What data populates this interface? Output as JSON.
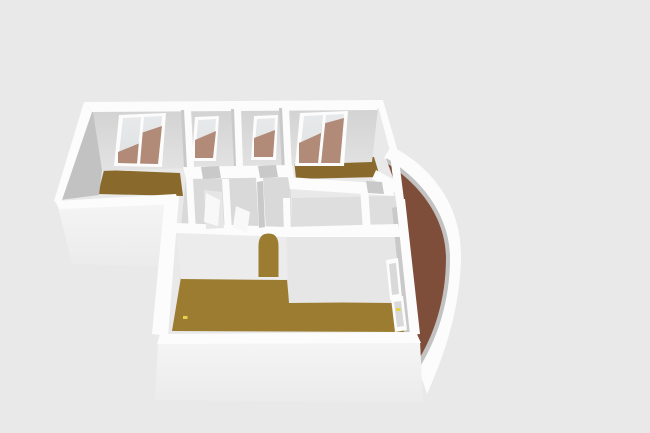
{
  "canvas": {
    "width": 650,
    "height": 433
  },
  "palette": {
    "background": "#e9e9e9",
    "wall_top": "#fcfcfc",
    "outer_from": "#f5f5f5",
    "outer_to": "#ebebeb",
    "face_top_from": "#d2d2d2",
    "face_top_to": "#e3e3e3",
    "wall_face_dark": "#c2c2c2",
    "wall_face_mid": "#c9c9c9",
    "wall_face_lit": "#ececec",
    "wall_face_lit2": "#e6e6e6",
    "hall_floor": "#d9d9d9",
    "hall_floor_light": "#dedede",
    "parquet_dark": "#8a6a2c",
    "parquet_line_dark": "#785b22",
    "parquet_gold": "#9c7c30",
    "parquet_line_gold": "#876826",
    "brick": "#7f4e3a",
    "brick_line": "#693a2c",
    "glass": "#e7e9ea",
    "glass_to": "#dfe2e3",
    "glass_reflection": "#b28a78",
    "door_opening": "#c9c9c9",
    "door_leaf": "#f8f8f8",
    "outlet_yellow": "#e3d34c"
  },
  "scene": {
    "description": "3D aerial render of an L-shaped apartment floor plan with white walls",
    "rooms": [
      {
        "name": "room-top-left",
        "floor": "parquet",
        "window": "french-double"
      },
      {
        "name": "room-small-left",
        "floor": "hidden",
        "window": "single"
      },
      {
        "name": "room-small-right",
        "floor": "hidden",
        "window": "single"
      },
      {
        "name": "room-top-right",
        "floor": "parquet",
        "window": "double"
      },
      {
        "name": "hallway",
        "floor": "bare"
      },
      {
        "name": "room-middle-right",
        "floor": "bare"
      },
      {
        "name": "living-room",
        "floor": "parquet",
        "feature": "arched-doorway"
      },
      {
        "name": "balcony",
        "floor": "brick",
        "shape": "curved-crescent"
      }
    ],
    "window_count": 6,
    "door_opening_count": 5,
    "outlet_count": 2
  }
}
